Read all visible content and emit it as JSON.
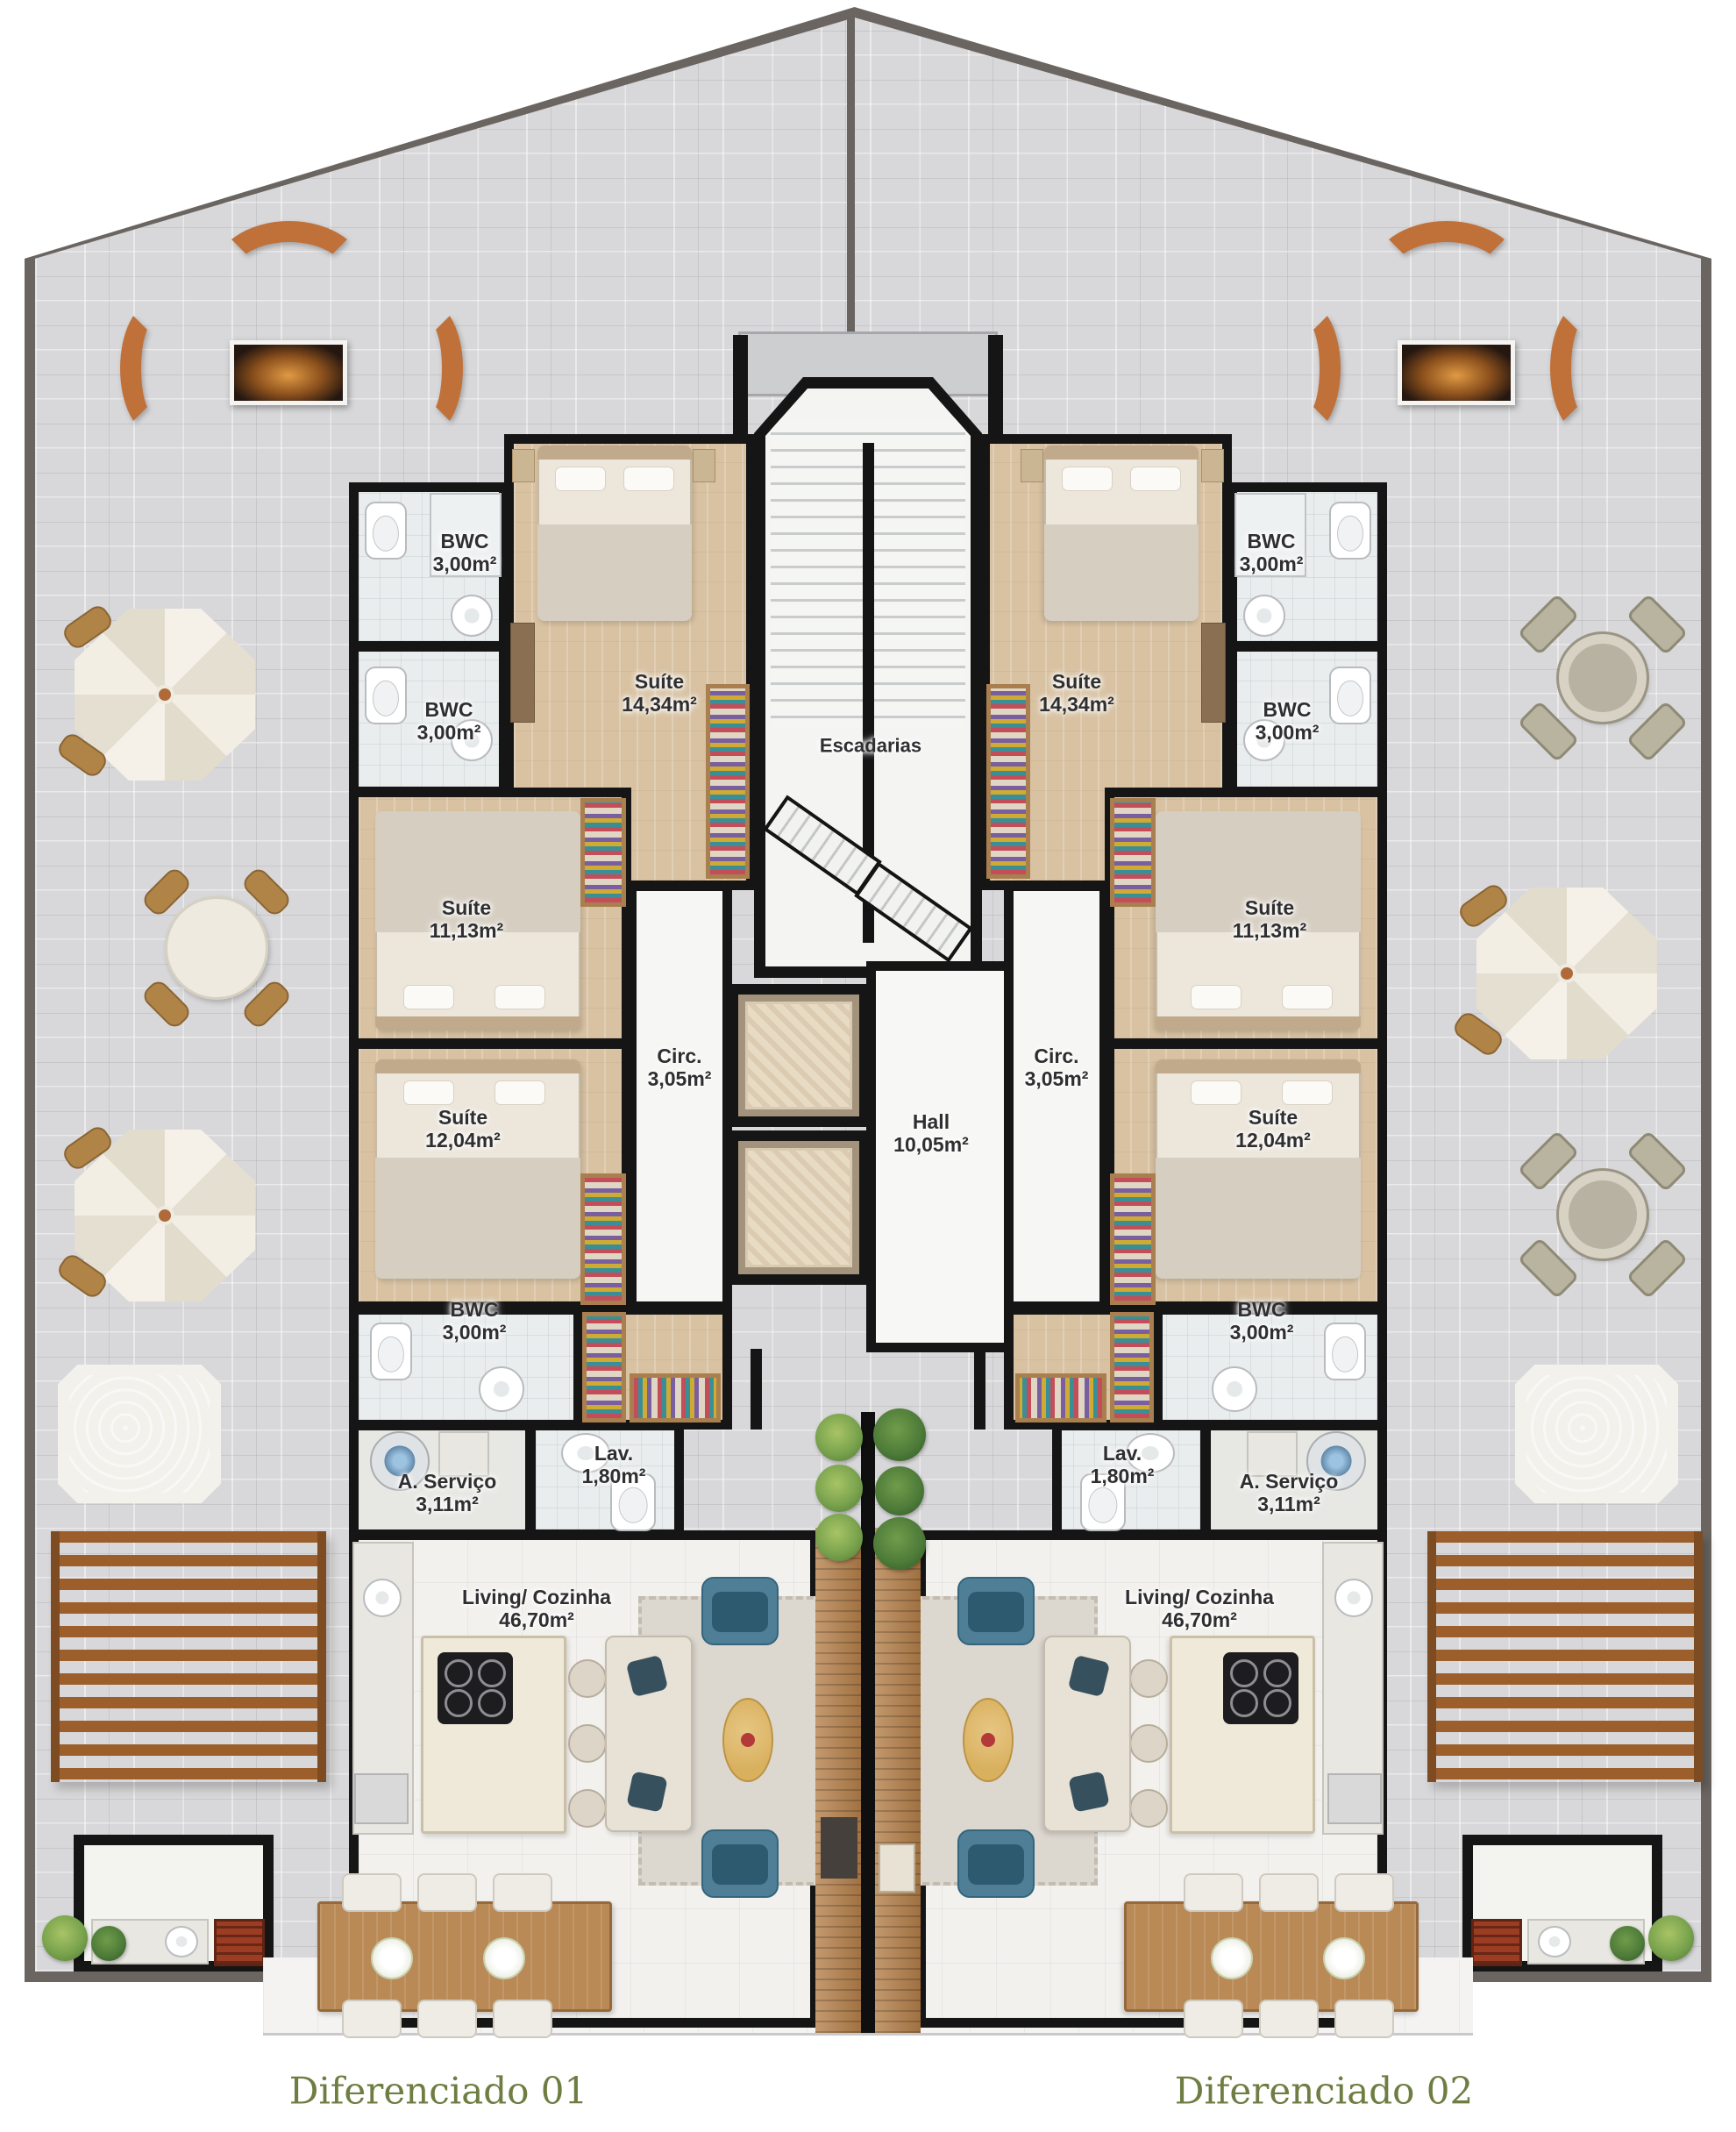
{
  "footer": {
    "left_label": "Diferenciado 01",
    "right_label": "Diferenciado 02"
  },
  "core": {
    "stairs_label": "Escadarias",
    "hall": {
      "name": "Hall",
      "area": "10,05m²"
    }
  },
  "units": {
    "left": {
      "suite_large": {
        "name": "Suíte",
        "area": "14,34m²"
      },
      "bwc_upper_a": {
        "name": "BWC",
        "area": "3,00m²"
      },
      "bwc_upper_b": {
        "name": "BWC",
        "area": "3,00m²"
      },
      "suite_mid": {
        "name": "Suíte",
        "area": "11,13m²"
      },
      "suite_lower": {
        "name": "Suíte",
        "area": "12,04m²"
      },
      "circulation": {
        "name": "Circ.",
        "area": "3,05m²"
      },
      "bwc_lower": {
        "name": "BWC",
        "area": "3,00m²"
      },
      "lavatory": {
        "name": "Lav.",
        "area": "1,80m²"
      },
      "service": {
        "name": "A. Serviço",
        "area": "3,11m²"
      },
      "living": {
        "name": "Living/ Cozinha",
        "area": "46,70m²"
      }
    },
    "right": {
      "suite_large": {
        "name": "Suíte",
        "area": "14,34m²"
      },
      "bwc_upper_a": {
        "name": "BWC",
        "area": "3,00m²"
      },
      "bwc_upper_b": {
        "name": "BWC",
        "area": "3,00m²"
      },
      "suite_mid": {
        "name": "Suíte",
        "area": "11,13m²"
      },
      "suite_lower": {
        "name": "Suíte",
        "area": "12,04m²"
      },
      "circulation": {
        "name": "Circ.",
        "area": "3,05m²"
      },
      "bwc_lower": {
        "name": "BWC",
        "area": "3,00m²"
      },
      "lavatory": {
        "name": "Lav.",
        "area": "1,80m²"
      },
      "service": {
        "name": "A. Serviço",
        "area": "3,11m²"
      },
      "living": {
        "name": "Living/ Cozinha",
        "area": "46,70m²"
      }
    }
  },
  "colors": {
    "wall": "#151515",
    "terrace_tile": "#d8d8da",
    "terrace_outline": "#6b6561",
    "wood_floor": "#d8c2a2",
    "bath_floor": "#e9edee",
    "living_floor": "#f2f1ee",
    "bench_orange": "#c0713a",
    "deck_wood": "#b5804a",
    "water_teal": "#8ecbc9",
    "label_text": "#2f2f31",
    "footer_green": "#6e7d42"
  }
}
